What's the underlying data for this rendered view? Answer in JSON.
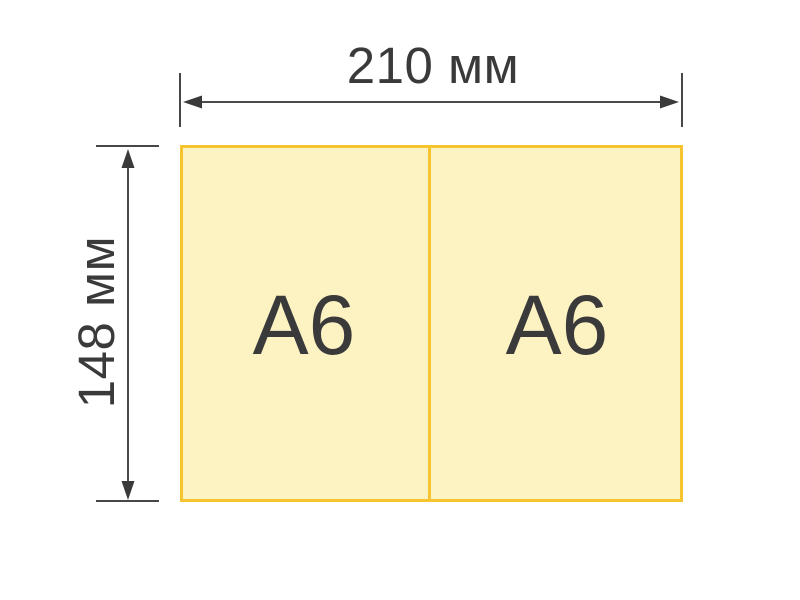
{
  "canvas": {
    "background": "#FFFFFF"
  },
  "sheet": {
    "fill": "#FCF2C2",
    "border_color": "#F6C42F",
    "cells": [
      {
        "label": "A6"
      },
      {
        "label": "A6"
      }
    ]
  },
  "dimensions": {
    "width": {
      "label": "210 мм"
    },
    "height": {
      "label": "148 мм"
    },
    "line_color": "#4A4A4A",
    "arrow_color": "#3A3A3A",
    "text_color": "#3A3A3A"
  }
}
